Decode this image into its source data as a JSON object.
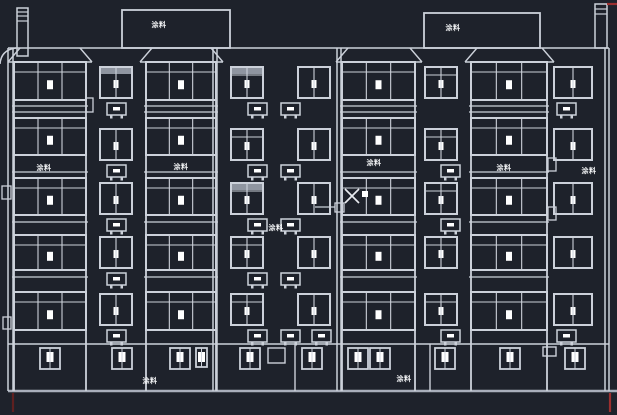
{
  "app": {
    "name": "cad-elevation-viewport"
  },
  "colors": {
    "background": "#1e222b",
    "line": "#ccd1da",
    "line_dim": "#a9afbb",
    "bright": "#ffffff",
    "gray_fill": "#8f95a0",
    "red": "#9c2f2f",
    "red_dim": "#5f2020",
    "label_text": "#f3f4f6",
    "cursor": "#e8ebf0"
  },
  "labels": [
    {
      "text": "涂料",
      "x": 159,
      "y": 27,
      "place": "rooftop-box-left"
    },
    {
      "text": "涂料",
      "x": 453,
      "y": 30,
      "place": "rooftop-box-right"
    },
    {
      "text": "涂料",
      "x": 44,
      "y": 170,
      "place": "bay1-band"
    },
    {
      "text": "涂料",
      "x": 181,
      "y": 169,
      "place": "bay2-band"
    },
    {
      "text": "涂料",
      "x": 374,
      "y": 165,
      "place": "bay3-band"
    },
    {
      "text": "涂料",
      "x": 276,
      "y": 230,
      "place": "mid-wall"
    },
    {
      "text": "涂料",
      "x": 504,
      "y": 170,
      "place": "bay4-band"
    },
    {
      "text": "涂料",
      "x": 589,
      "y": 173,
      "place": "right-wall"
    },
    {
      "text": "涂料",
      "x": 150,
      "y": 383,
      "place": "ground-left"
    },
    {
      "text": "涂料",
      "x": 404,
      "y": 381,
      "place": "ground-right"
    }
  ],
  "cursor": {
    "crosshair": {
      "cx": 352,
      "cy": 196,
      "arm": 7
    },
    "pickbox": {
      "x": 362,
      "y": 191,
      "size": 6
    },
    "osnap_square": {
      "x": 335,
      "y": 203,
      "size": 9
    },
    "rubber_line": {
      "x1": 315,
      "y1": 207,
      "x2": 335,
      "y2": 207
    }
  },
  "building": {
    "roof_line": {
      "x1": 8,
      "x2": 609,
      "y": 48
    },
    "ground_wall_top": {
      "x1": 8,
      "x2": 609,
      "y": 344
    },
    "ground_line": {
      "x1": 8,
      "x2": 617,
      "y": 391
    },
    "canopy": {
      "path": "M 0 64 Q 1 50 16 48"
    },
    "wall_doubles": [
      [
        8,
        13
      ],
      [
        213,
        217
      ],
      [
        337,
        341
      ],
      [
        605,
        609
      ]
    ],
    "ground_walls": [
      295,
      430
    ],
    "red_marks": [
      {
        "x1": 13,
        "y1": 393,
        "x2": 13,
        "y2": 412,
        "tone": "dim"
      },
      {
        "x1": 610,
        "y1": 393,
        "x2": 610,
        "y2": 412,
        "tone": "red"
      },
      {
        "x1": 607,
        "y1": 4,
        "x2": 617,
        "y2": 4,
        "tone": "red"
      }
    ],
    "rooftop_boxes": [
      {
        "x": 122,
        "y": 10,
        "w": 108,
        "h": 38
      },
      {
        "x": 424,
        "y": 13,
        "w": 116,
        "h": 35
      }
    ],
    "chimneys": [
      {
        "x": 17,
        "y": 8,
        "w": 11,
        "h": 48,
        "bands": [
          12,
          16,
          21
        ]
      },
      {
        "x": 595,
        "y": 4,
        "w": 12,
        "h": 44,
        "bands": [
          9,
          14
        ]
      }
    ],
    "parapets": [
      {
        "bx1": 8,
        "tx1": 20,
        "tx2": 80,
        "bx2": 92
      },
      {
        "bx1": 140,
        "tx1": 152,
        "tx2": 211,
        "bx2": 223
      },
      {
        "bx1": 336,
        "tx1": 348,
        "tx2": 410,
        "bx2": 422
      },
      {
        "bx1": 465,
        "tx1": 477,
        "tx2": 542,
        "bx2": 554
      }
    ],
    "parapet_base_y": 62,
    "big_bays": [
      {
        "x": 14,
        "w": 72
      },
      {
        "x": 146,
        "w": 70
      },
      {
        "x": 342,
        "w": 73
      },
      {
        "x": 471,
        "w": 76
      }
    ],
    "big_rows": [
      {
        "y": 62,
        "h": 38
      },
      {
        "y": 118,
        "h": 37
      },
      {
        "y": 178,
        "h": 37
      },
      {
        "y": 235,
        "h": 35
      },
      {
        "y": 292,
        "h": 38
      }
    ],
    "big_slab_lines": [
      106,
      112,
      172,
      222,
      277
    ],
    "small_rows": [
      {
        "y": 67
      },
      {
        "y": 129
      },
      {
        "y": 183
      },
      {
        "y": 237
      },
      {
        "y": 294
      }
    ],
    "small_row_h": 31,
    "small_cols": [
      {
        "x": 100,
        "w": 32,
        "acx": 107,
        "ac_rows": [
          0,
          1,
          2,
          3,
          4
        ],
        "gray_rows": [
          0
        ],
        "transom": false
      },
      {
        "x": 231,
        "w": 32,
        "acx": 248,
        "ac_rows": [
          0,
          1,
          2,
          3,
          4
        ],
        "gray_rows": [
          0,
          2
        ],
        "transom": true
      },
      {
        "x": 298,
        "w": 32,
        "acx": 281,
        "ac_rows": [
          0,
          1,
          2,
          3,
          4
        ],
        "gray_rows": [],
        "transom": false
      },
      {
        "x": 425,
        "w": 32,
        "acx": 441,
        "ac_rows": [
          1,
          2,
          4
        ],
        "gray_rows": [],
        "transom": true
      },
      {
        "x": 554,
        "w": 38,
        "acx": 557,
        "ac_rows": [
          0,
          4
        ],
        "gray_rows": [],
        "transom": false
      }
    ],
    "extra_acs": [
      {
        "x": 312,
        "y": 330
      }
    ],
    "brackets": [
      {
        "x": 86,
        "y": 98,
        "w": 7,
        "h": 14
      },
      {
        "x": 2,
        "y": 186,
        "w": 9,
        "h": 13
      },
      {
        "x": 3,
        "y": 317,
        "w": 8,
        "h": 12
      },
      {
        "x": 548,
        "y": 158,
        "w": 8,
        "h": 13
      },
      {
        "x": 548,
        "y": 207,
        "w": 8,
        "h": 13
      }
    ],
    "ground": {
      "window_y": 348,
      "window_w": 20,
      "window_h": 21,
      "windows": [
        {
          "x": 40
        },
        {
          "x": 112
        },
        {
          "x": 170
        },
        {
          "x": 196,
          "w": 11,
          "h": 19
        },
        {
          "x": 240
        },
        {
          "x": 302
        },
        {
          "x": 348
        },
        {
          "x": 370
        },
        {
          "x": 435
        },
        {
          "x": 500
        },
        {
          "x": 565
        }
      ],
      "empty_squares": [
        {
          "x": 268,
          "y": 348,
          "w": 17,
          "h": 15
        },
        {
          "x": 543,
          "y": 347,
          "w": 13,
          "h": 9
        }
      ]
    }
  }
}
